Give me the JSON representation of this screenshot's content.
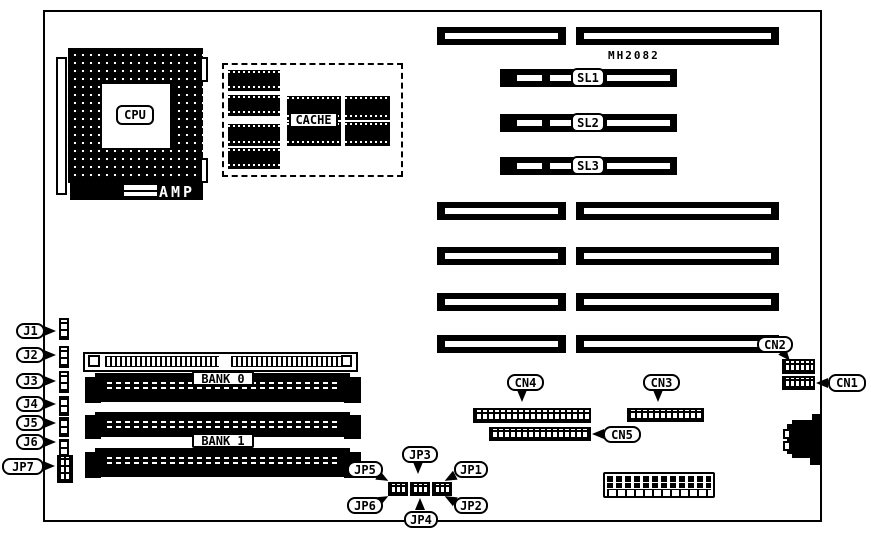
{
  "board": {
    "chip_marking": "MH2082",
    "cpu": {
      "label": "CPU",
      "socket_brand": "AMP"
    },
    "cache_label": "CACHE",
    "sl_slots": [
      "SL1",
      "SL2",
      "SL3"
    ],
    "banks": [
      "BANK 0",
      "BANK 1"
    ],
    "j_headers": [
      "J1",
      "J2",
      "J3",
      "J4",
      "J5",
      "J6"
    ],
    "jumpers": [
      "JP1",
      "JP2",
      "JP3",
      "JP4",
      "JP5",
      "JP6",
      "JP7"
    ],
    "connectors": [
      "CN1",
      "CN2",
      "CN3",
      "CN4",
      "CN5"
    ],
    "colors": {
      "ink": "#000000",
      "paper": "#ffffff"
    }
  }
}
